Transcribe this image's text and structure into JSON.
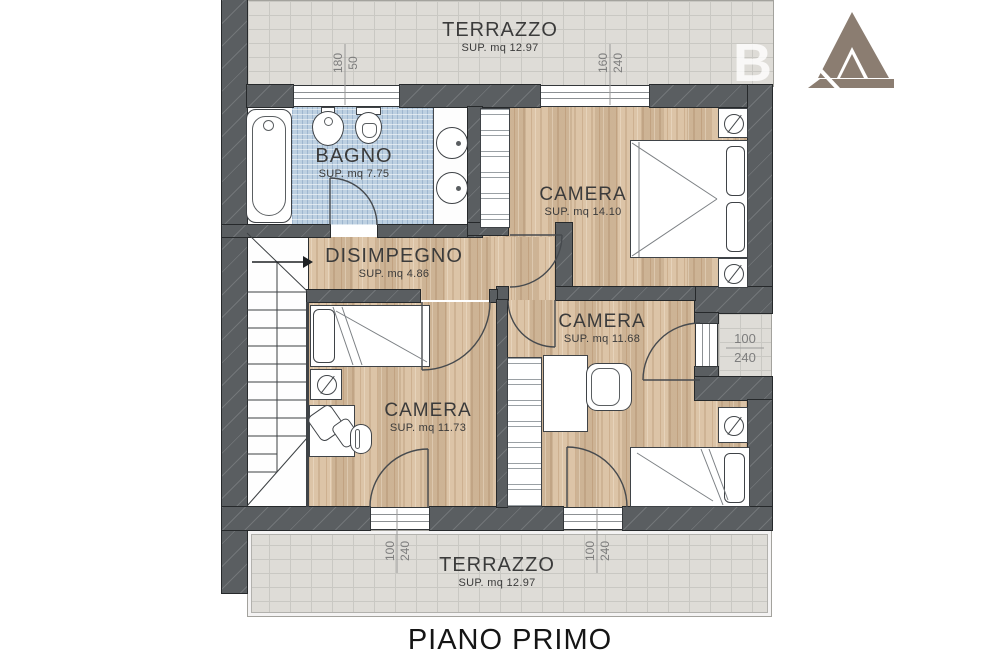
{
  "title": "PIANO PRIMO",
  "watermark": {
    "letter": "B"
  },
  "rooms": {
    "terrazzo_top": {
      "name": "TERRAZZO",
      "area": "SUP. mq 12.97"
    },
    "bagno": {
      "name": "BAGNO",
      "area": "SUP. mq 7.75"
    },
    "camera_grande": {
      "name": "CAMERA",
      "area": "SUP. mq 14.10"
    },
    "disimpegno": {
      "name": "DISIMPEGNO",
      "area": "SUP. mq 4.86"
    },
    "camera_media": {
      "name": "CAMERA",
      "area": "SUP. mq 11.68"
    },
    "camera_piccola": {
      "name": "CAMERA",
      "area": "SUP. mq 11.73"
    },
    "terrazzo_bottom": {
      "name": "TERRAZZO",
      "area": "SUP. mq 12.97"
    }
  },
  "dimensions": {
    "bagno_window": {
      "w": "180",
      "h": "50"
    },
    "camera_grande_window": {
      "w": "160",
      "h": "240"
    },
    "camera_media_window": {
      "w": "100",
      "h": "240"
    },
    "terrazzo_door_left": {
      "w": "100",
      "h": "240"
    },
    "terrazzo_door_right": {
      "w": "100",
      "h": "240"
    }
  },
  "colors": {
    "wall": "#5a5e61",
    "wood_floor": "#d8bd9d",
    "terrace_tile": "#dedcd7",
    "bath_tile": "#bdd0e1",
    "linework": "#464a4e",
    "logo": "#8b7d71",
    "label_text": "#3b3b3b"
  }
}
